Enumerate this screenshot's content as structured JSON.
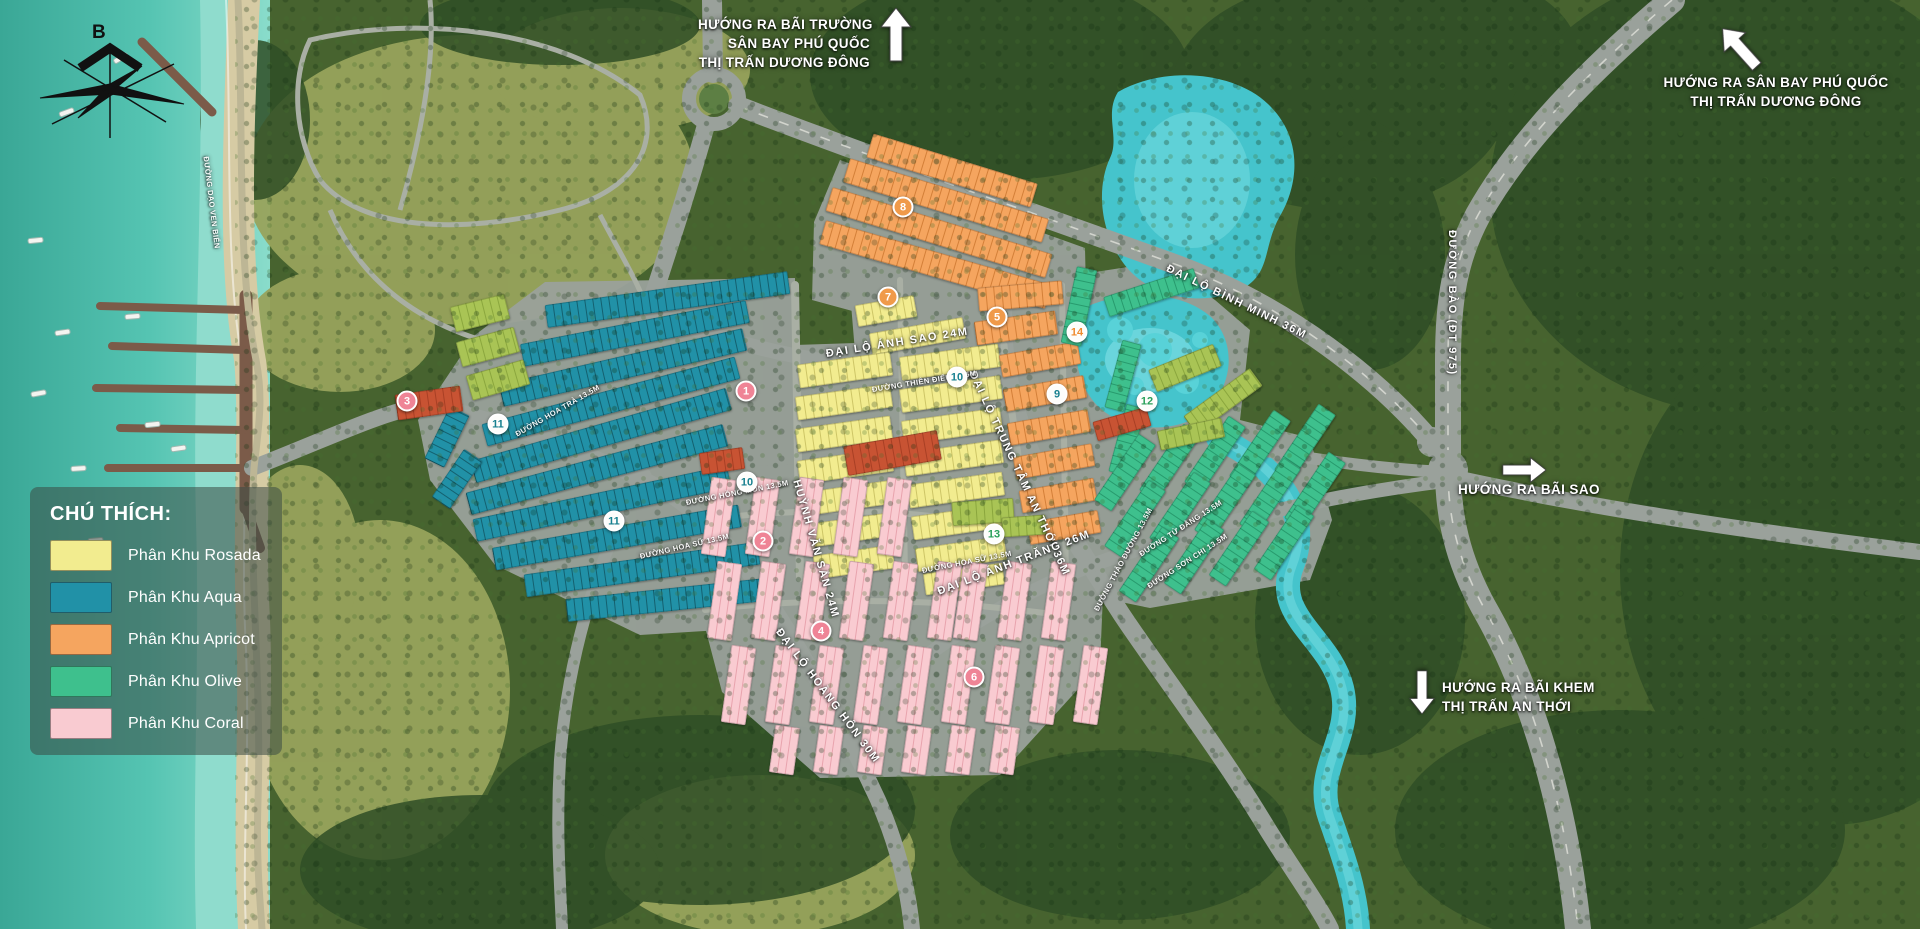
{
  "map": {
    "compass": {
      "label": "B"
    },
    "legend": {
      "title": "CHÚ THÍCH:",
      "items": [
        {
          "label": "Phân Khu Rosada",
          "color": "#f2ec8f"
        },
        {
          "label": "Phân Khu Aqua",
          "color": "#2191a7"
        },
        {
          "label": "Phân Khu Apricot",
          "color": "#f5a55f"
        },
        {
          "label": "Phân Khu Olive",
          "color": "#3ec08d"
        },
        {
          "label": "Phân Khu Coral",
          "color": "#f9cbd1"
        }
      ]
    },
    "signs": {
      "top_center": {
        "line1": "HƯỚNG RA BÃI TRƯỜNG",
        "line2": "SÂN BAY PHÚ QUỐC",
        "line3": "THỊ TRẤN DƯƠNG ĐÔNG"
      },
      "top_right": {
        "line1": "HƯỚNG RA SÂN BAY PHÚ QUỐC",
        "line2": "THỊ TRẤN DƯƠNG ĐÔNG"
      },
      "bai_sao": {
        "line1": "HƯỚNG RA BÃI SAO"
      },
      "bai_khem": {
        "line1": "HƯỚNG RA BÃI KHEM",
        "line2": "THỊ TRẤN AN THỚI"
      }
    },
    "road_labels": [
      {
        "text": "ĐẠI LỘ ÁNH SAO 24M",
        "x": 826,
        "y": 348,
        "rot": -9
      },
      {
        "text": "ĐẠI LỘ BÌNH MINH 36M",
        "x": 1167,
        "y": 262,
        "rot": 26
      },
      {
        "text": "ĐẠI LỘ TRUNG TÂM AN THỚI 36M",
        "x": 972,
        "y": 366,
        "rot": 65
      },
      {
        "text": "ĐẠI LỘ HOÀNG HÔN 30M",
        "x": 778,
        "y": 624,
        "rot": 53
      },
      {
        "text": "ĐẠI LỘ ÁNH TRĂNG 26M",
        "x": 938,
        "y": 586,
        "rot": -21
      },
      {
        "text": "ĐƯỜNG BÀO (ĐT 975)",
        "x": 1452,
        "y": 224,
        "rot": 90
      },
      {
        "text": "HUỲNH VĂN SẮN 24M",
        "x": 796,
        "y": 474,
        "rot": 74
      }
    ],
    "street_labels": [
      {
        "text": "ĐƯỜNG THIÊN ĐIỂU 13.5M",
        "x": 872,
        "y": 385,
        "rot": -9
      },
      {
        "text": "ĐƯỜNG HỒNG MÔN 13.5M",
        "x": 686,
        "y": 498,
        "rot": -11
      },
      {
        "text": "ĐƯỜNG HOA SỮ 13.5M",
        "x": 640,
        "y": 552,
        "rot": -13
      },
      {
        "text": "ĐƯỜNG HOA SỮ 13.5M",
        "x": 922,
        "y": 566,
        "rot": -11
      },
      {
        "text": "ĐƯỜNG HOA TRÀ 13.5M",
        "x": 516,
        "y": 430,
        "rot": -30
      },
      {
        "text": "ĐƯỜNG THẢO ĐƯỜNG 13.5M",
        "x": 1096,
        "y": 606,
        "rot": -62
      },
      {
        "text": "ĐƯỜNG TỬ ĐẰNG 13.5M",
        "x": 1140,
        "y": 550,
        "rot": -33
      },
      {
        "text": "ĐƯỜNG SƠN CHI 13.5M",
        "x": 1148,
        "y": 582,
        "rot": -33
      },
      {
        "text": "ĐƯỜNG DẠO VEN BIỂN",
        "x": 206,
        "y": 152,
        "rot": 83
      }
    ],
    "markers": [
      {
        "n": "1",
        "x": 746,
        "y": 391,
        "variant": "pink"
      },
      {
        "n": "2",
        "x": 763,
        "y": 541,
        "variant": "pink"
      },
      {
        "n": "3",
        "x": 407,
        "y": 401,
        "variant": "pink"
      },
      {
        "n": "4",
        "x": 821,
        "y": 631,
        "variant": "pink"
      },
      {
        "n": "5",
        "x": 997,
        "y": 317,
        "variant": "orange"
      },
      {
        "n": "6",
        "x": 974,
        "y": 677,
        "variant": "pink"
      },
      {
        "n": "7",
        "x": 888,
        "y": 297,
        "variant": "orange"
      },
      {
        "n": "8",
        "x": 903,
        "y": 207,
        "variant": "orange"
      },
      {
        "n": "9",
        "x": 1057,
        "y": 394,
        "variant": "teal"
      },
      {
        "n": "10",
        "x": 957,
        "y": 377,
        "variant": "teal"
      },
      {
        "n": "10",
        "x": 747,
        "y": 482,
        "variant": "teal"
      },
      {
        "n": "11",
        "x": 498,
        "y": 424,
        "variant": "teal"
      },
      {
        "n": "11",
        "x": 614,
        "y": 521,
        "variant": "teal"
      },
      {
        "n": "12",
        "x": 1147,
        "y": 401,
        "variant": "green"
      },
      {
        "n": "13",
        "x": 994,
        "y": 534,
        "variant": "green"
      },
      {
        "n": "14",
        "x": 1077,
        "y": 332,
        "variant": "orangetext"
      }
    ],
    "palette": {
      "rosada": {
        "base": "#f2ec8f",
        "shade": "#cdc566"
      },
      "aqua": {
        "base": "#2191a7",
        "shade": "#14606f"
      },
      "apricot": {
        "base": "#f5a55f",
        "shade": "#d37f38"
      },
      "olive": {
        "base": "#3ec08d",
        "shade": "#279a6d"
      },
      "coral": {
        "base": "#f9cbd1",
        "shade": "#e8a3ad"
      },
      "lime": {
        "base": "#a9c455",
        "shade": "#8aa63d"
      },
      "red": {
        "base": "#c85333",
        "shade": "#a83f24"
      },
      "water": "#45c4cc",
      "sea": "#55c4b2",
      "road": "#9aa19b"
    }
  }
}
